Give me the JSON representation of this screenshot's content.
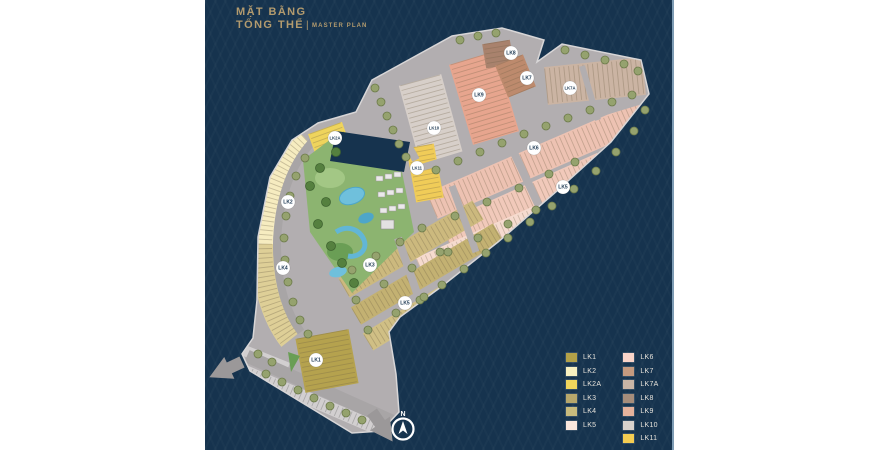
{
  "title": {
    "line1": "MẶT BẰNG",
    "line2": "TỔNG THỂ",
    "separator": "|",
    "subtitle": "MASTER PLAN"
  },
  "compass": {
    "label": "N"
  },
  "legend_columns": {
    "first": 6
  },
  "legend": [
    {
      "label": "LK1",
      "color": "#b3a148"
    },
    {
      "label": "LK2",
      "color": "#f8f0c0"
    },
    {
      "label": "LK2A",
      "color": "#f0d55c"
    },
    {
      "label": "LK3",
      "color": "#b7a76b"
    },
    {
      "label": "LK4",
      "color": "#c9bb7d"
    },
    {
      "label": "LK5",
      "color": "#fbe7dd"
    },
    {
      "label": "LK6",
      "color": "#f9d4c9"
    },
    {
      "label": "LK7",
      "color": "#c59a7f"
    },
    {
      "label": "LK7A",
      "color": "#c9b5a6"
    },
    {
      "label": "LK8",
      "color": "#a68d7b"
    },
    {
      "label": "LK9",
      "color": "#e5b29c"
    },
    {
      "label": "LK10",
      "color": "#d9d2cc"
    },
    {
      "label": "LK11",
      "color": "#f4cd52"
    }
  ],
  "map_labels": [
    {
      "text": "LK8",
      "x": 511,
      "y": 53
    },
    {
      "text": "LK7",
      "x": 527,
      "y": 78
    },
    {
      "text": "LK7A",
      "x": 570,
      "y": 88
    },
    {
      "text": "LK9",
      "x": 479,
      "y": 95
    },
    {
      "text": "LK10",
      "x": 434,
      "y": 128
    },
    {
      "text": "LK2A",
      "x": 335,
      "y": 138
    },
    {
      "text": "LK6",
      "x": 534,
      "y": 148
    },
    {
      "text": "LK11",
      "x": 417,
      "y": 168
    },
    {
      "text": "LK5",
      "x": 563,
      "y": 187
    },
    {
      "text": "LK2",
      "x": 288,
      "y": 202
    },
    {
      "text": "LK3",
      "x": 370,
      "y": 265
    },
    {
      "text": "LK4",
      "x": 283,
      "y": 268
    },
    {
      "text": "LK5",
      "x": 405,
      "y": 303
    },
    {
      "text": "LK1",
      "x": 316,
      "y": 360
    }
  ],
  "colors": {
    "background": "#ffffff",
    "panel": "#16334e",
    "title_gold": "#b39b6e",
    "road": "#b2aeb0",
    "road_dark": "#a8a5a6",
    "road_light": "#d2cfd0",
    "sidewalk_edge": "#d8d6d7",
    "park_green": "#8cb470",
    "park_green_light": "#a3c785",
    "park_green_dark": "#6a9e55",
    "pool_blue": "#6fc0dc",
    "pool_blue_dark": "#4ea6c9",
    "tree_green": "#95a26e",
    "tree_ring": "#6c7a4a",
    "tree_dark": "#55803f",
    "label_circle": "#ffffff",
    "label_text": "#16334e",
    "legend_text": "#e8e4dc",
    "arrow_gray": "#9b9899"
  }
}
